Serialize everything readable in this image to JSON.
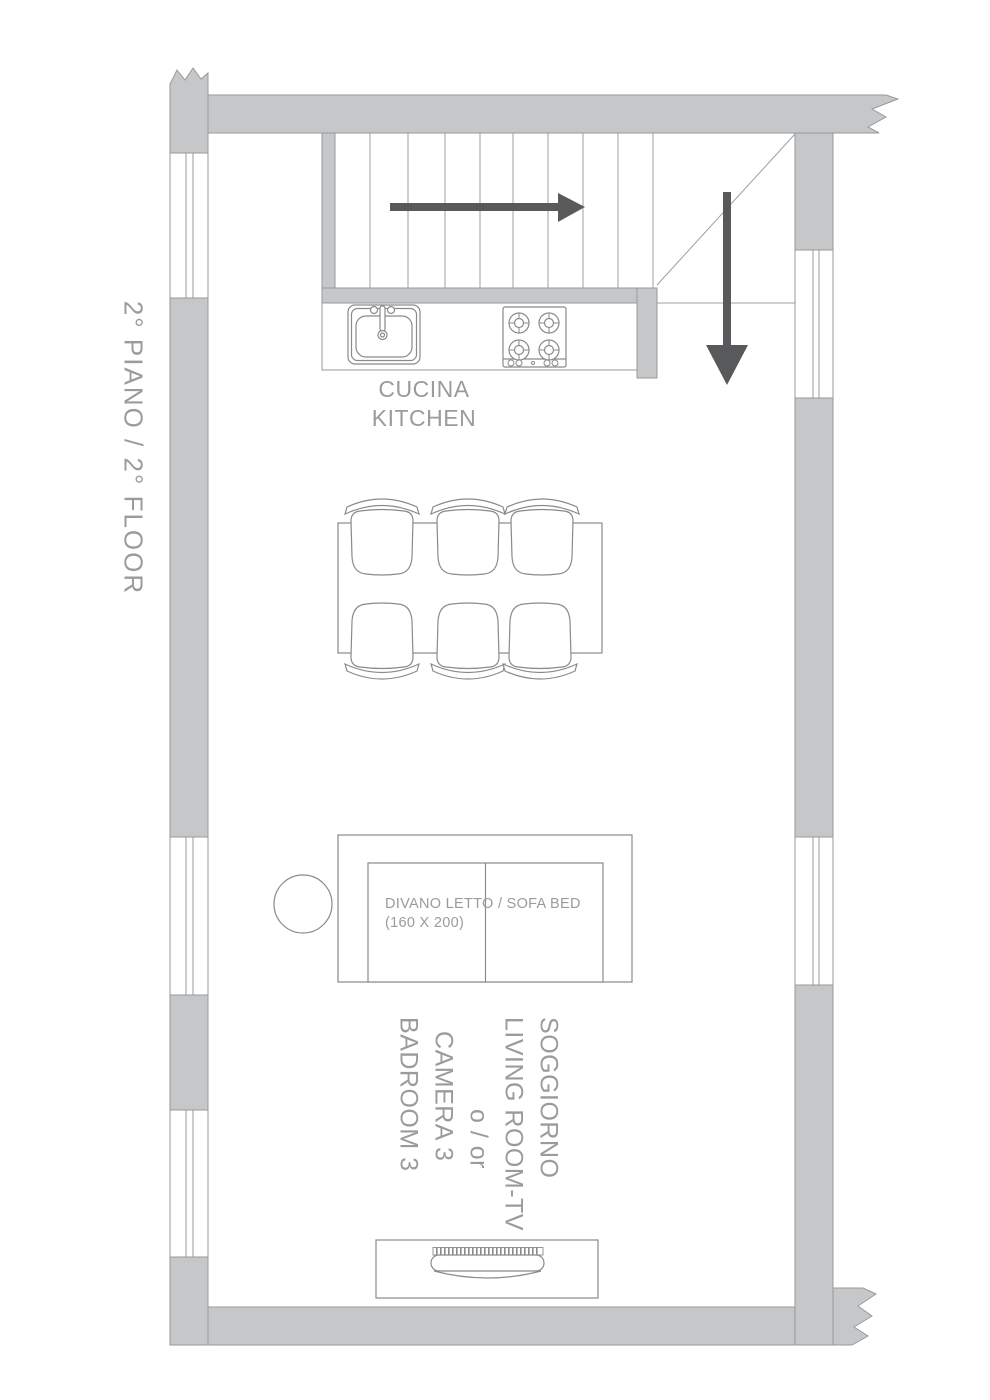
{
  "floor": {
    "label": "2°  PIANO / 2° FLOOR"
  },
  "kitchen": {
    "line1": "CUCINA",
    "line2": "KITCHEN"
  },
  "sofa": {
    "line1": "DIVANO LETTO / SOFA BED",
    "line2": "(160 X 200)"
  },
  "room": {
    "line1": "SOGGIORNO",
    "line2": "LIVING ROOM-TV",
    "line3": "o / or",
    "line4": "CAMERA 3",
    "line5": "BADROOM 3"
  },
  "fixtures": {
    "stairs_up_arrow": "right-arrow-icon",
    "stairs_down_arrow": "down-arrow-icon",
    "sink": "sink-icon",
    "stove": "stove-icon",
    "dining_table_seats": 6,
    "tv": "tv-icon"
  },
  "colors": {
    "wall_fill": "#c5c7c9",
    "wall_outline": "#97999b",
    "furniture_line": "#8a8a8a",
    "text": "#9b9b9b",
    "arrow": "#58595b",
    "background": "#ffffff"
  }
}
